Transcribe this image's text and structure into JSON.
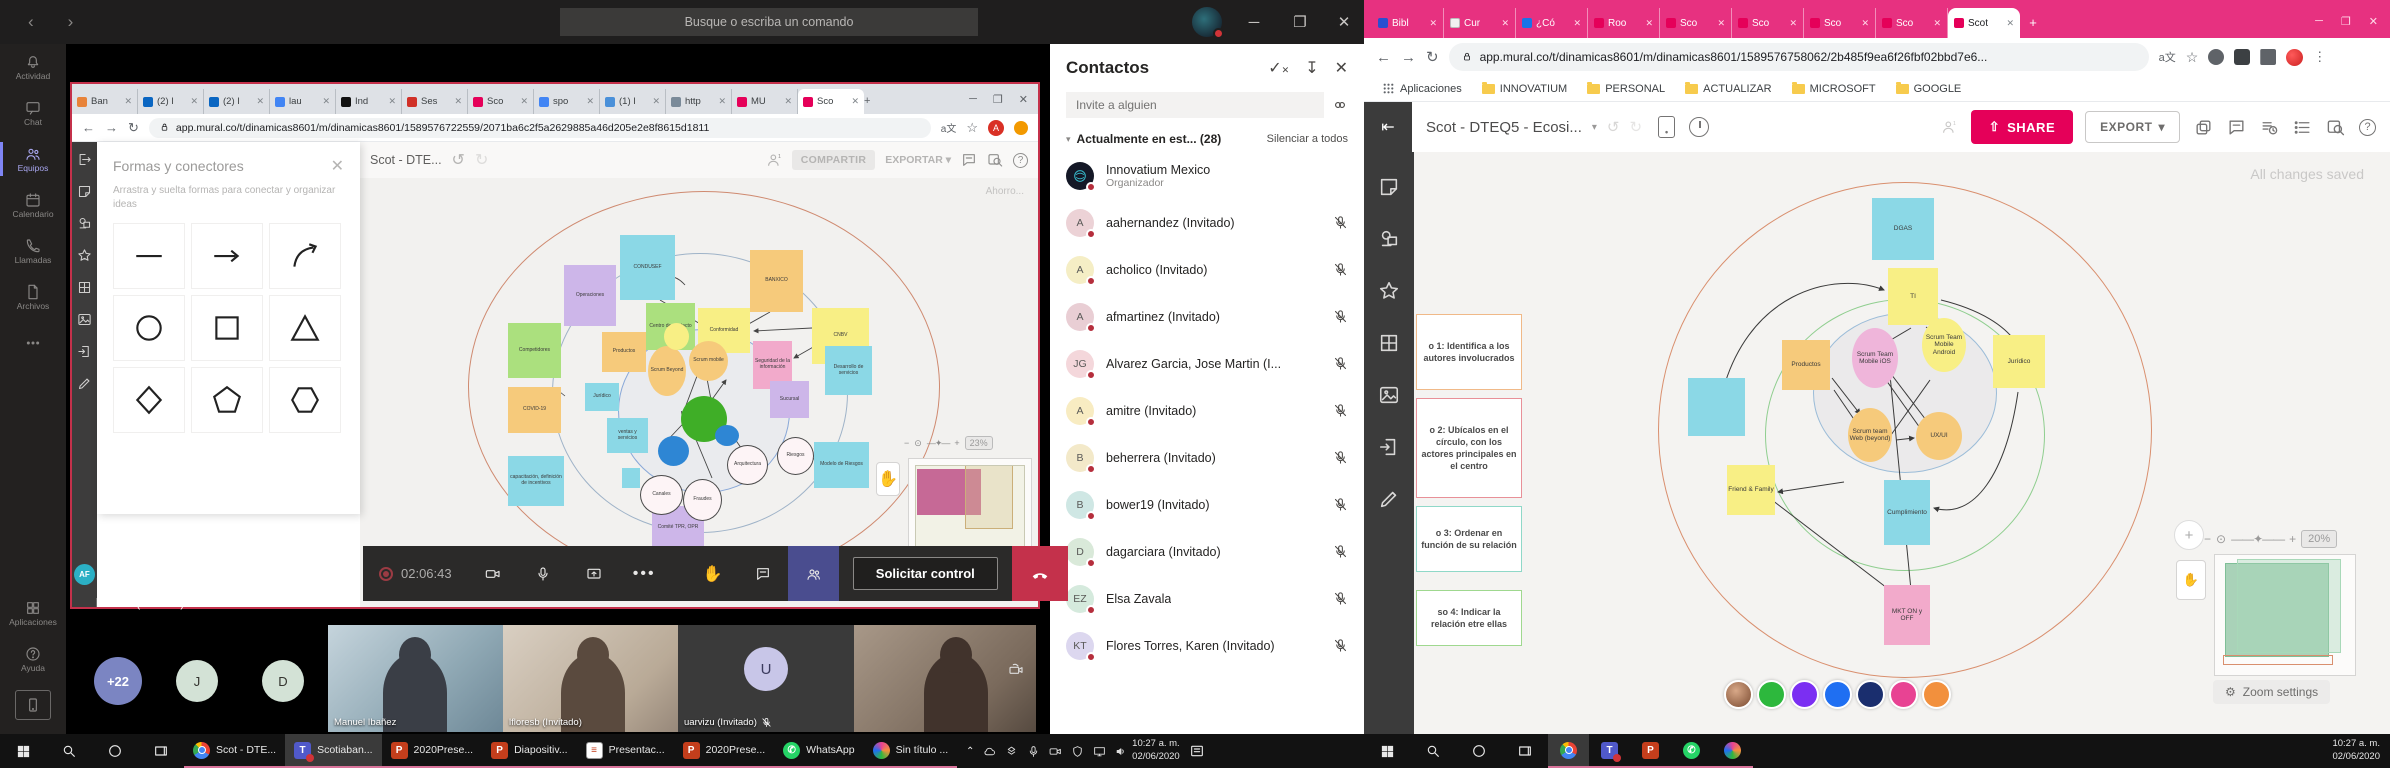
{
  "teams": {
    "titlebar": {
      "search_placeholder": "Busque o escriba un comando"
    },
    "rail": [
      {
        "label": "Actividad",
        "icon": "bell"
      },
      {
        "label": "Chat",
        "icon": "chat"
      },
      {
        "label": "Equipos",
        "icon": "teams",
        "active": true
      },
      {
        "label": "Calendario",
        "icon": "calendar"
      },
      {
        "label": "Llamadas",
        "icon": "phone"
      },
      {
        "label": "Archivos",
        "icon": "files"
      },
      {
        "label": "",
        "icon": "more"
      }
    ],
    "rail_bottom": [
      {
        "label": "Aplicaciones",
        "icon": "apps"
      },
      {
        "label": "Ayuda",
        "icon": "help"
      }
    ],
    "controls": {
      "time": "02:06:43",
      "request_control": "Solicitar control"
    },
    "stage_label": "lfloresb (Invitado)",
    "filmstrip": {
      "overflow": "+22",
      "initials": [
        "J",
        "D"
      ],
      "videos": [
        {
          "name": "Manuel Ibañez",
          "muted": false
        },
        {
          "name": "lfloresb (Invitado)",
          "muted": false
        },
        {
          "name": "uarvizu (Invitado)",
          "muted": true,
          "initial": "U"
        },
        {
          "name": "",
          "muted": false
        }
      ]
    },
    "contacts": {
      "title": "Contactos",
      "invite_placeholder": "Invite a alguien",
      "section": "Actualmente en est...",
      "count": "(28)",
      "mute_all": "Silenciar a todos",
      "people": [
        {
          "initials": "",
          "name": "Innovatium Mexico",
          "sub": "Organizador",
          "color": "#141826",
          "logo": true,
          "mic_off": false
        },
        {
          "initials": "A",
          "name": "aahernandez (Invitado)",
          "color": "#ecd2d6",
          "mic_off": true
        },
        {
          "initials": "A",
          "name": "acholico (Invitado)",
          "color": "#f5eec5",
          "mic_off": true
        },
        {
          "initials": "A",
          "name": "afmartinez (Invitado)",
          "color": "#e9ced4",
          "mic_off": true
        },
        {
          "initials": "JG",
          "name": "Alvarez Garcia, Jose Martin (I...",
          "color": "#f4d7db",
          "mic_off": true
        },
        {
          "initials": "A",
          "name": "amitre (Invitado)",
          "color": "#f8ecc2",
          "mic_off": true
        },
        {
          "initials": "B",
          "name": "beherrera (Invitado)",
          "color": "#f3e9c9",
          "mic_off": true
        },
        {
          "initials": "B",
          "name": "bower19 (Invitado)",
          "color": "#cfe7e4",
          "mic_off": true
        },
        {
          "initials": "D",
          "name": "dagarciara (Invitado)",
          "color": "#d9e9d9",
          "mic_off": true
        },
        {
          "initials": "EZ",
          "name": "Elsa Zavala",
          "color": "#d5eadd",
          "mic_off": true
        },
        {
          "initials": "KT",
          "name": "Flores Torres, Karen (Invitado)",
          "color": "#dcd7ef",
          "mic_off": true
        }
      ]
    }
  },
  "shared_browser": {
    "tabs": [
      {
        "label": "Ban",
        "color": "#e8833a"
      },
      {
        "label": "(2) I",
        "color": "#0a66c2"
      },
      {
        "label": "(2) I",
        "color": "#0a66c2"
      },
      {
        "label": "lau",
        "color": "#4285f4"
      },
      {
        "label": "Ind",
        "color": "#111111"
      },
      {
        "label": "Ses",
        "color": "#d03027"
      },
      {
        "label": "Sco",
        "color": "#e50059"
      },
      {
        "label": "spo",
        "color": "#4285f4"
      },
      {
        "label": "(1) I",
        "color": "#4a90d9"
      },
      {
        "label": "http",
        "color": "#7a8a99"
      },
      {
        "label": "MU",
        "color": "#e50059"
      },
      {
        "label": "Sco",
        "color": "#e50059",
        "active": true
      }
    ],
    "url": "app.mural.co/t/dinamicas8601/m/dinamicas8601/1589576722559/2071ba6c2f5a2629885a46d205e2e8f8615d1811"
  },
  "mural_left": {
    "shapes_panel": {
      "title": "Formas y conectores",
      "subtitle": "Arrastra y suelta formas para conectar y organizar ideas",
      "shapes": [
        "line",
        "arrow",
        "curved-arrow",
        "circle",
        "square",
        "triangle",
        "diamond",
        "pentagon",
        "hexagon"
      ]
    },
    "header": {
      "title": "Scot - DTE...",
      "share": "COMPARTIR",
      "export": "EXPORTAR"
    },
    "saving": "Ahorro...",
    "zoom": "23%",
    "notes": [
      {
        "t": "Operaciones",
        "c": "n-purple",
        "x": 204,
        "y": 87,
        "w": 52,
        "h": 61
      },
      {
        "t": "CONDUSEF",
        "c": "n-cyan",
        "x": 260,
        "y": 57,
        "w": 55,
        "h": 65
      },
      {
        "t": "BANXICO",
        "c": "n-orange",
        "x": 390,
        "y": 72,
        "w": 53,
        "h": 62
      },
      {
        "t": "Competidores",
        "c": "n-green",
        "x": 148,
        "y": 145,
        "w": 53,
        "h": 55
      },
      {
        "t": "Centro de contacto",
        "c": "n-green",
        "x": 286,
        "y": 125,
        "w": 49,
        "h": 47
      },
      {
        "t": "Conformidad",
        "c": "n-yellow",
        "x": 338,
        "y": 130,
        "w": 52,
        "h": 45
      },
      {
        "t": "CNBV",
        "c": "n-yellow",
        "x": 452,
        "y": 130,
        "w": 57,
        "h": 56
      },
      {
        "t": "Productos",
        "c": "n-orange",
        "x": 242,
        "y": 154,
        "w": 44,
        "h": 40
      },
      {
        "t": "Seguridad de la información",
        "c": "n-pink",
        "x": 393,
        "y": 163,
        "w": 39,
        "h": 48
      },
      {
        "t": "Desarrollo de servicios",
        "c": "n-cyan",
        "x": 465,
        "y": 168,
        "w": 47,
        "h": 49
      },
      {
        "t": "COVID-19",
        "c": "n-orange",
        "x": 148,
        "y": 209,
        "w": 53,
        "h": 46
      },
      {
        "t": "Jurídico",
        "c": "n-cyan",
        "x": 225,
        "y": 205,
        "w": 34,
        "h": 28
      },
      {
        "t": "ventas y servicios",
        "c": "n-cyan",
        "x": 247,
        "y": 240,
        "w": 41,
        "h": 35
      },
      {
        "t": "capacitación, definición de incentivos",
        "c": "n-cyan",
        "x": 148,
        "y": 278,
        "w": 56,
        "h": 50
      },
      {
        "t": "",
        "c": "n-cyan",
        "x": 262,
        "y": 290,
        "w": 18,
        "h": 20
      },
      {
        "t": "Comité TPR, OPR",
        "c": "n-purple",
        "x": 292,
        "y": 328,
        "w": 52,
        "h": 43
      },
      {
        "t": "Sucursal",
        "c": "n-purple",
        "x": 410,
        "y": 203,
        "w": 39,
        "h": 37
      },
      {
        "t": "Modelo de Riesgos",
        "c": "n-cyan",
        "x": 454,
        "y": 264,
        "w": 55,
        "h": 46
      },
      {
        "t": "Riesgos",
        "c": "n-whitec",
        "x": 417,
        "y": 259,
        "w": 37,
        "h": 38
      },
      {
        "t": "Arquitectura",
        "c": "n-whitec",
        "x": 367,
        "y": 267,
        "w": 41,
        "h": 40
      },
      {
        "t": "Canales",
        "c": "n-whitec",
        "x": 280,
        "y": 297,
        "w": 43,
        "h": 40
      },
      {
        "t": "Fraudes",
        "c": "n-whitec",
        "x": 323,
        "y": 301,
        "w": 39,
        "h": 42
      },
      {
        "t": "",
        "c": "n-greenc",
        "x": 321,
        "y": 218,
        "w": 46,
        "h": 46
      },
      {
        "t": "",
        "c": "n-bluec",
        "x": 298,
        "y": 258,
        "w": 31,
        "h": 30
      },
      {
        "t": "",
        "c": "n-bluec",
        "x": 355,
        "y": 247,
        "w": 24,
        "h": 21
      },
      {
        "t": "Scrum Beyond",
        "c": "n-orangec",
        "x": 288,
        "y": 168,
        "w": 38,
        "h": 50
      },
      {
        "t": "Scrum mobile",
        "c": "n-orangec",
        "x": 329,
        "y": 163,
        "w": 39,
        "h": 40
      },
      {
        "t": "",
        "c": "n-yellowc",
        "x": 304,
        "y": 145,
        "w": 25,
        "h": 27
      }
    ]
  },
  "mural_right": {
    "header": {
      "title": "Scot - DTEQ5 - Ecosi...",
      "share": "SHARE",
      "export": "EXPORT"
    },
    "saved": "All changes saved",
    "zoom": "20%",
    "zoom_settings": "Zoom settings",
    "steps": [
      {
        "t": "o 1: Identifica a los autores involucrados",
        "border": "#f0b988",
        "y": 162,
        "h": 76
      },
      {
        "t": "o 2: Ubícalos en el círculo, con los actores principales en el centro",
        "border": "#e89098",
        "y": 246,
        "h": 100
      },
      {
        "t": "o 3: Ordenar en función de su relación",
        "border": "#8fd8c8",
        "y": 354,
        "h": 66
      },
      {
        "t": "so 4: Indicar la relación etre ellas",
        "border": "#9fd88f",
        "y": 438,
        "h": 56
      }
    ],
    "notes": [
      {
        "t": "DGAS",
        "c": "n-cyan",
        "x": 458,
        "y": 46,
        "w": 62,
        "h": 62
      },
      {
        "t": "",
        "c": "n-cyan",
        "x": 274,
        "y": 226,
        "w": 57,
        "h": 58
      },
      {
        "t": "TI",
        "c": "n-yellow",
        "x": 474,
        "y": 116,
        "w": 50,
        "h": 57
      },
      {
        "t": "Productos",
        "c": "n-orange",
        "x": 368,
        "y": 188,
        "w": 48,
        "h": 50
      },
      {
        "t": "Jurídico",
        "c": "n-yellow",
        "x": 579,
        "y": 183,
        "w": 52,
        "h": 53
      },
      {
        "t": "Scrum Team Mobile iOS",
        "c": "n-pinkc",
        "x": 438,
        "y": 176,
        "w": 46,
        "h": 60
      },
      {
        "t": "Scrum Team Mobile Android",
        "c": "n-yellowc",
        "x": 508,
        "y": 166,
        "w": 44,
        "h": 54
      },
      {
        "t": "Scrum team Web (beyond)",
        "c": "n-orangec",
        "x": 434,
        "y": 256,
        "w": 44,
        "h": 54
      },
      {
        "t": "UX/UI",
        "c": "n-orangec",
        "x": 502,
        "y": 260,
        "w": 46,
        "h": 48
      },
      {
        "t": "Friend & Family",
        "c": "n-yellow",
        "x": 313,
        "y": 313,
        "w": 48,
        "h": 50
      },
      {
        "t": "Cumplimiento",
        "c": "n-cyan",
        "x": 470,
        "y": 328,
        "w": 46,
        "h": 65
      },
      {
        "t": "MKT ON y OFF",
        "c": "n-pink",
        "x": 470,
        "y": 433,
        "w": 46,
        "h": 60
      }
    ],
    "avatars": [
      "#b07a5a",
      "#2db83d",
      "#7b2ff2",
      "#1f6ff2",
      "#1a2e6e",
      "#e84393",
      "#f2903d"
    ]
  },
  "right_browser": {
    "tabs": [
      {
        "label": "Bibl",
        "color": "#2a4fd0"
      },
      {
        "label": "Cur",
        "color": "#f1f1f1"
      },
      {
        "label": "¿Có",
        "color": "#1a73e8"
      },
      {
        "label": "Roo",
        "color": "#e50059"
      },
      {
        "label": "Sco",
        "color": "#e50059"
      },
      {
        "label": "Sco",
        "color": "#e50059"
      },
      {
        "label": "Sco",
        "color": "#e50059"
      },
      {
        "label": "Sco",
        "color": "#e50059"
      },
      {
        "label": "Scot",
        "color": "#e50059",
        "active": true
      }
    ],
    "url": "app.mural.co/t/dinamicas8601/m/dinamicas8601/1589576758062/2b485f9ea6f26fbf02bbd7e6...",
    "bookmarks_label": "Aplicaciones",
    "bookmarks": [
      "INNOVATIUM",
      "PERSONAL",
      "ACTUALIZAR",
      "MICROSOFT",
      "GOOGLE"
    ]
  },
  "taskbar": {
    "left_apps": [
      {
        "label": "Scot - DTE...",
        "icon": "chrome"
      },
      {
        "label": "Scotiaban...",
        "icon": "teams",
        "active": true
      },
      {
        "label": "2020Prese...",
        "icon": "ppt"
      },
      {
        "label": "Diapositiv...",
        "icon": "ppt"
      },
      {
        "label": "Presentac...",
        "icon": "doc"
      },
      {
        "label": "2020Prese...",
        "icon": "ppt"
      },
      {
        "label": "WhatsApp",
        "icon": "whatsapp"
      },
      {
        "label": "Sin título ...",
        "icon": "paint"
      }
    ],
    "right_apps": [
      {
        "icon": "chrome",
        "active": true
      },
      {
        "icon": "teams",
        "badge": true
      },
      {
        "icon": "ppt"
      },
      {
        "icon": "whatsapp"
      },
      {
        "icon": "paint"
      }
    ],
    "clock_time": "10:27 a. m.",
    "clock_date": "02/06/2020"
  }
}
